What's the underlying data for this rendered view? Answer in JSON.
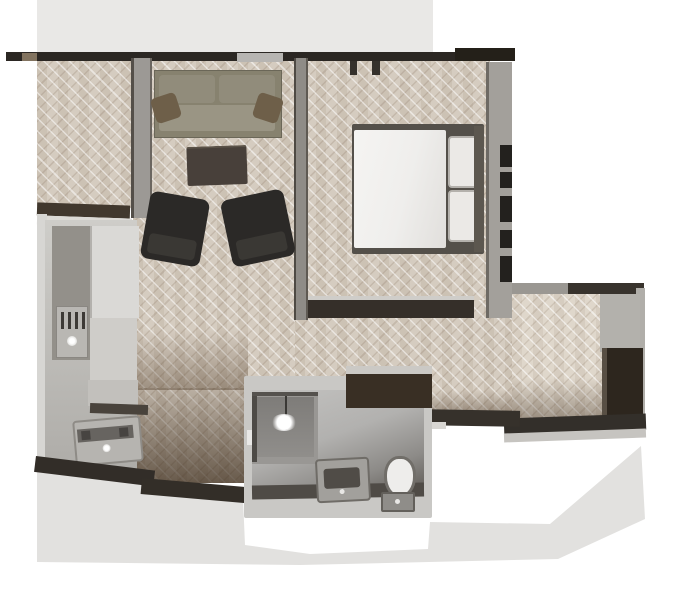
{
  "scene": {
    "title": "3D apartment floor plan render",
    "view": "top-down",
    "has_text": false,
    "rooms": [
      {
        "name": "living-room",
        "floor": "herringbone-wood",
        "furniture": [
          "sofa",
          "sofa-accent-pillow-left",
          "sofa-accent-pillow-right",
          "coffee-table",
          "armchair-left",
          "armchair-right"
        ]
      },
      {
        "name": "alcove",
        "floor": "herringbone-wood",
        "furniture": []
      },
      {
        "name": "bedroom",
        "floor": "herringbone-wood",
        "furniture": [
          "double-bed",
          "duvet",
          "pillow-top",
          "pillow-bottom",
          "headboard"
        ],
        "features": [
          "window-slats-right-wall",
          "door-stubs-top-wall"
        ]
      },
      {
        "name": "kitchen",
        "floor": "gray-screed",
        "furniture": [
          "counter-run",
          "cooktop",
          "tall-cabinet",
          "base-cabinet",
          "washing-machine"
        ]
      },
      {
        "name": "bathroom",
        "floor": "gray-screed",
        "furniture": [
          "shower-cabin",
          "pendant-light",
          "vanity-basin",
          "toilet",
          "cistern"
        ]
      },
      {
        "name": "hallway",
        "floor": "herringbone-wood",
        "furniture": [
          "wardrobe"
        ]
      }
    ],
    "palette": {
      "background": "#ffffff",
      "backdrop_gray": "#e9e8e6",
      "shadow_gray": "#e2e1df",
      "floor_wood": "#d5ccc0",
      "floor_wood_light": "#dfd7cb",
      "wall_dark": "#2b2723",
      "wall_brown": "#41382e",
      "wall_gray": "#9c9995",
      "wall_light_gray": "#c9c8c5",
      "kitchen_floor": "#c6c4c0",
      "counter": "#93908a",
      "sofa": "#87826f",
      "sofa_pillow": "#6e5f49",
      "coffee_table": "#48403a",
      "armchair": "#2b2927",
      "bed_linen": "#efeeec",
      "headboard": "#5c574f",
      "bathroom_floor": "#b2b1af",
      "wardrobe": "#2d261e"
    }
  }
}
